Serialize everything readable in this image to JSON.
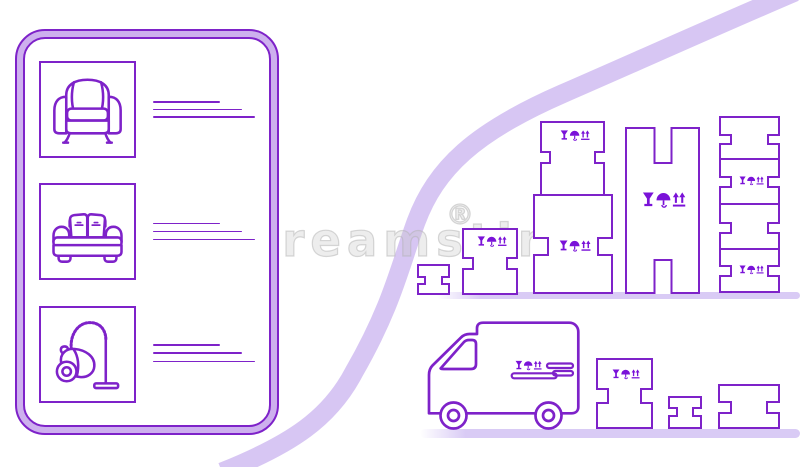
{
  "watermark": {
    "text": "dreamstime",
    "mark": "®"
  },
  "colors": {
    "outline_purple": "#7e22c9",
    "symbol_purple": "#7a12d8",
    "tablet_ring_lavender": "#cdb0ee",
    "swoosh_ribbon": "#d7c6f3",
    "ground_shadow": "#d9cbf5",
    "background": "#ffffff"
  },
  "scene": {
    "tablet_list": {
      "items": [
        {
          "icon": "armchair-icon",
          "placeholder_lines": 3
        },
        {
          "icon": "sofa-icon",
          "placeholder_lines": 3
        },
        {
          "icon": "vacuum-cleaner-icon",
          "placeholder_lines": 3
        }
      ]
    },
    "warehouse_boxes": {
      "count": 7,
      "fragile_marking": "wine-glass, umbrella, this-way-up arrows"
    },
    "loading_row": {
      "vehicle": "delivery-van",
      "van_logo": "fragile symbols with speed lines",
      "boxes": 3
    }
  }
}
